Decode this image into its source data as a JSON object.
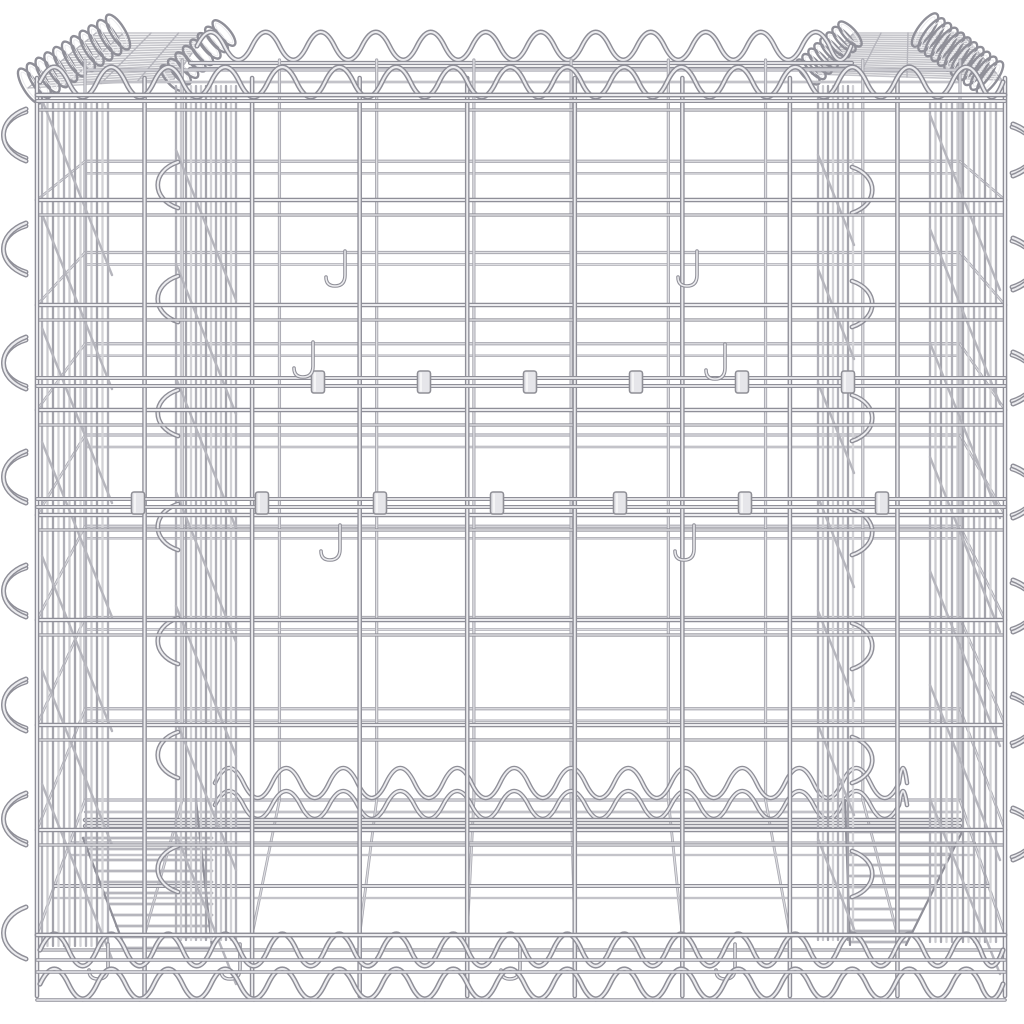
{
  "image": {
    "width": 1024,
    "height": 1024,
    "background": "#ffffff",
    "alt": "Product photo: silver galvanised steel wire gabion basket cube, front view, empty, with spiral edge bindings, mesh walls, inner partition walls, brace wires with sleeve clips and hooks"
  },
  "palette": {
    "background": "#ffffff",
    "wire_dark": "#8f8f98",
    "wire_mid": "#b6b6bd",
    "wire_light": "#ececef",
    "wire_faint": "#c6c6cb",
    "back_dark": "#a8a8b0",
    "back_light": "#dedee2",
    "band_tones": [
      "#b0b0b8",
      "#cbcbd0",
      "#a4a4ac",
      "#d2d2d6"
    ],
    "clip_fill": "#e6e6ea",
    "clip_stroke": "#8f8f96"
  },
  "scene": {
    "front": {
      "x0": 37,
      "x1": 1005,
      "y0": 95,
      "y1": 935,
      "nCols": 10,
      "nRows": 9,
      "colTop": 78,
      "colBottom": 996,
      "rowTwin": 15
    },
    "back": {
      "x0": 85,
      "x1": 960,
      "y0": 70,
      "y1": 800,
      "colTop": 60,
      "rowTwin": 12
    },
    "topEdges": {
      "frontY": [
        95,
        101
      ],
      "backY": [
        63,
        69
      ],
      "backX0": 190,
      "backX1": 852
    },
    "bottomEdges": {
      "backY": [
        820,
        826
      ],
      "frontY": [
        935,
        960,
        972,
        1000
      ],
      "floorY": [
        843,
        886
      ]
    },
    "spirals": {
      "topFront": {
        "x0": 40,
        "x1": 1003,
        "cy": 82,
        "amp": 15,
        "period": 57
      },
      "topBack": {
        "x0": 197,
        "x1": 851,
        "cy": 46,
        "amp": 14,
        "period": 55
      },
      "bottomBack": [
        {
          "x0": 215,
          "x1": 907,
          "cy": 783,
          "amp": 15,
          "period": 57
        },
        {
          "x0": 215,
          "x1": 907,
          "cy": 805,
          "amp": 14,
          "period": 57
        }
      ],
      "bottomFront": [
        {
          "x0": 40,
          "x1": 1003,
          "cy": 950,
          "amp": 16,
          "period": 57
        },
        {
          "x0": 40,
          "x1": 1003,
          "cy": 984,
          "amp": 15,
          "period": 57
        }
      ]
    },
    "bands": [
      {
        "name": "left-outer-side-panel",
        "x0": 42,
        "x1": 112,
        "step": 5.5,
        "y0": 100,
        "y1": 946,
        "curlX": 26,
        "curlBulge": -20,
        "curlY0": 135
      },
      {
        "name": "left-inner-partition",
        "x0": 176,
        "x1": 236,
        "step": 5.0,
        "y0": 86,
        "y1": 940,
        "curlX": 178,
        "curlBulge": -18,
        "curlY0": 185
      },
      {
        "name": "right-inner-partition",
        "x0": 818,
        "x1": 854,
        "step": 5.0,
        "y0": 86,
        "y1": 940,
        "curlX": 852,
        "curlBulge": 18,
        "curlY0": 190
      },
      {
        "name": "right-outer-side-panel",
        "x0": 930,
        "x1": 1000,
        "step": 5.5,
        "y0": 100,
        "y1": 942,
        "curlX": 1012,
        "curlBulge": 20,
        "curlY0": 150
      }
    ],
    "curlPeriod": 114,
    "braces": [
      {
        "y": 382,
        "clips": [
          318,
          424,
          530,
          636,
          742,
          848
        ]
      },
      {
        "y": 503,
        "clips": [
          138,
          262,
          380,
          497,
          620,
          745,
          882
        ]
      }
    ],
    "hooks": [
      [
        345,
        251
      ],
      [
        697,
        251
      ],
      [
        313,
        342
      ],
      [
        725,
        344
      ],
      [
        340,
        525
      ],
      [
        694,
        525
      ],
      [
        108,
        944
      ],
      [
        240,
        944
      ],
      [
        520,
        944
      ],
      [
        735,
        944
      ]
    ],
    "hatches": {
      "left": {
        "quad": [
          [
            28,
            88
          ],
          [
            96,
            33
          ],
          [
            206,
            33
          ],
          [
            174,
            79
          ]
        ],
        "n": 20
      },
      "right": {
        "quad": [
          [
            812,
            74
          ],
          [
            854,
            33
          ],
          [
            962,
            33
          ],
          [
            1002,
            80
          ]
        ],
        "n": 20
      }
    },
    "coils": {
      "left": {
        "a": [
          30,
          86
        ],
        "b": [
          118,
          32
        ],
        "n": 11,
        "rx": 7,
        "ry": 20
      },
      "leftInner": {
        "a": [
          172,
          78
        ],
        "b": [
          224,
          33
        ],
        "n": 8,
        "rx": 6,
        "ry": 16
      },
      "rightInner": {
        "a": [
          808,
          72
        ],
        "b": [
          850,
          34
        ],
        "n": 8,
        "rx": 6,
        "ry": 16
      },
      "right": {
        "a": [
          925,
          30
        ],
        "b": [
          990,
          78
        ],
        "n": 11,
        "rx": 7,
        "ry": 20
      }
    },
    "ladders": {
      "left": {
        "xFixed": 212,
        "xStart": 83,
        "slope": 0.38,
        "ya": 838,
        "yb": 948,
        "step": 11
      },
      "right": {
        "xFixed": 850,
        "xStart": 962,
        "slope": 0.5,
        "ya": 832,
        "yb": 945,
        "step": 11
      }
    }
  }
}
